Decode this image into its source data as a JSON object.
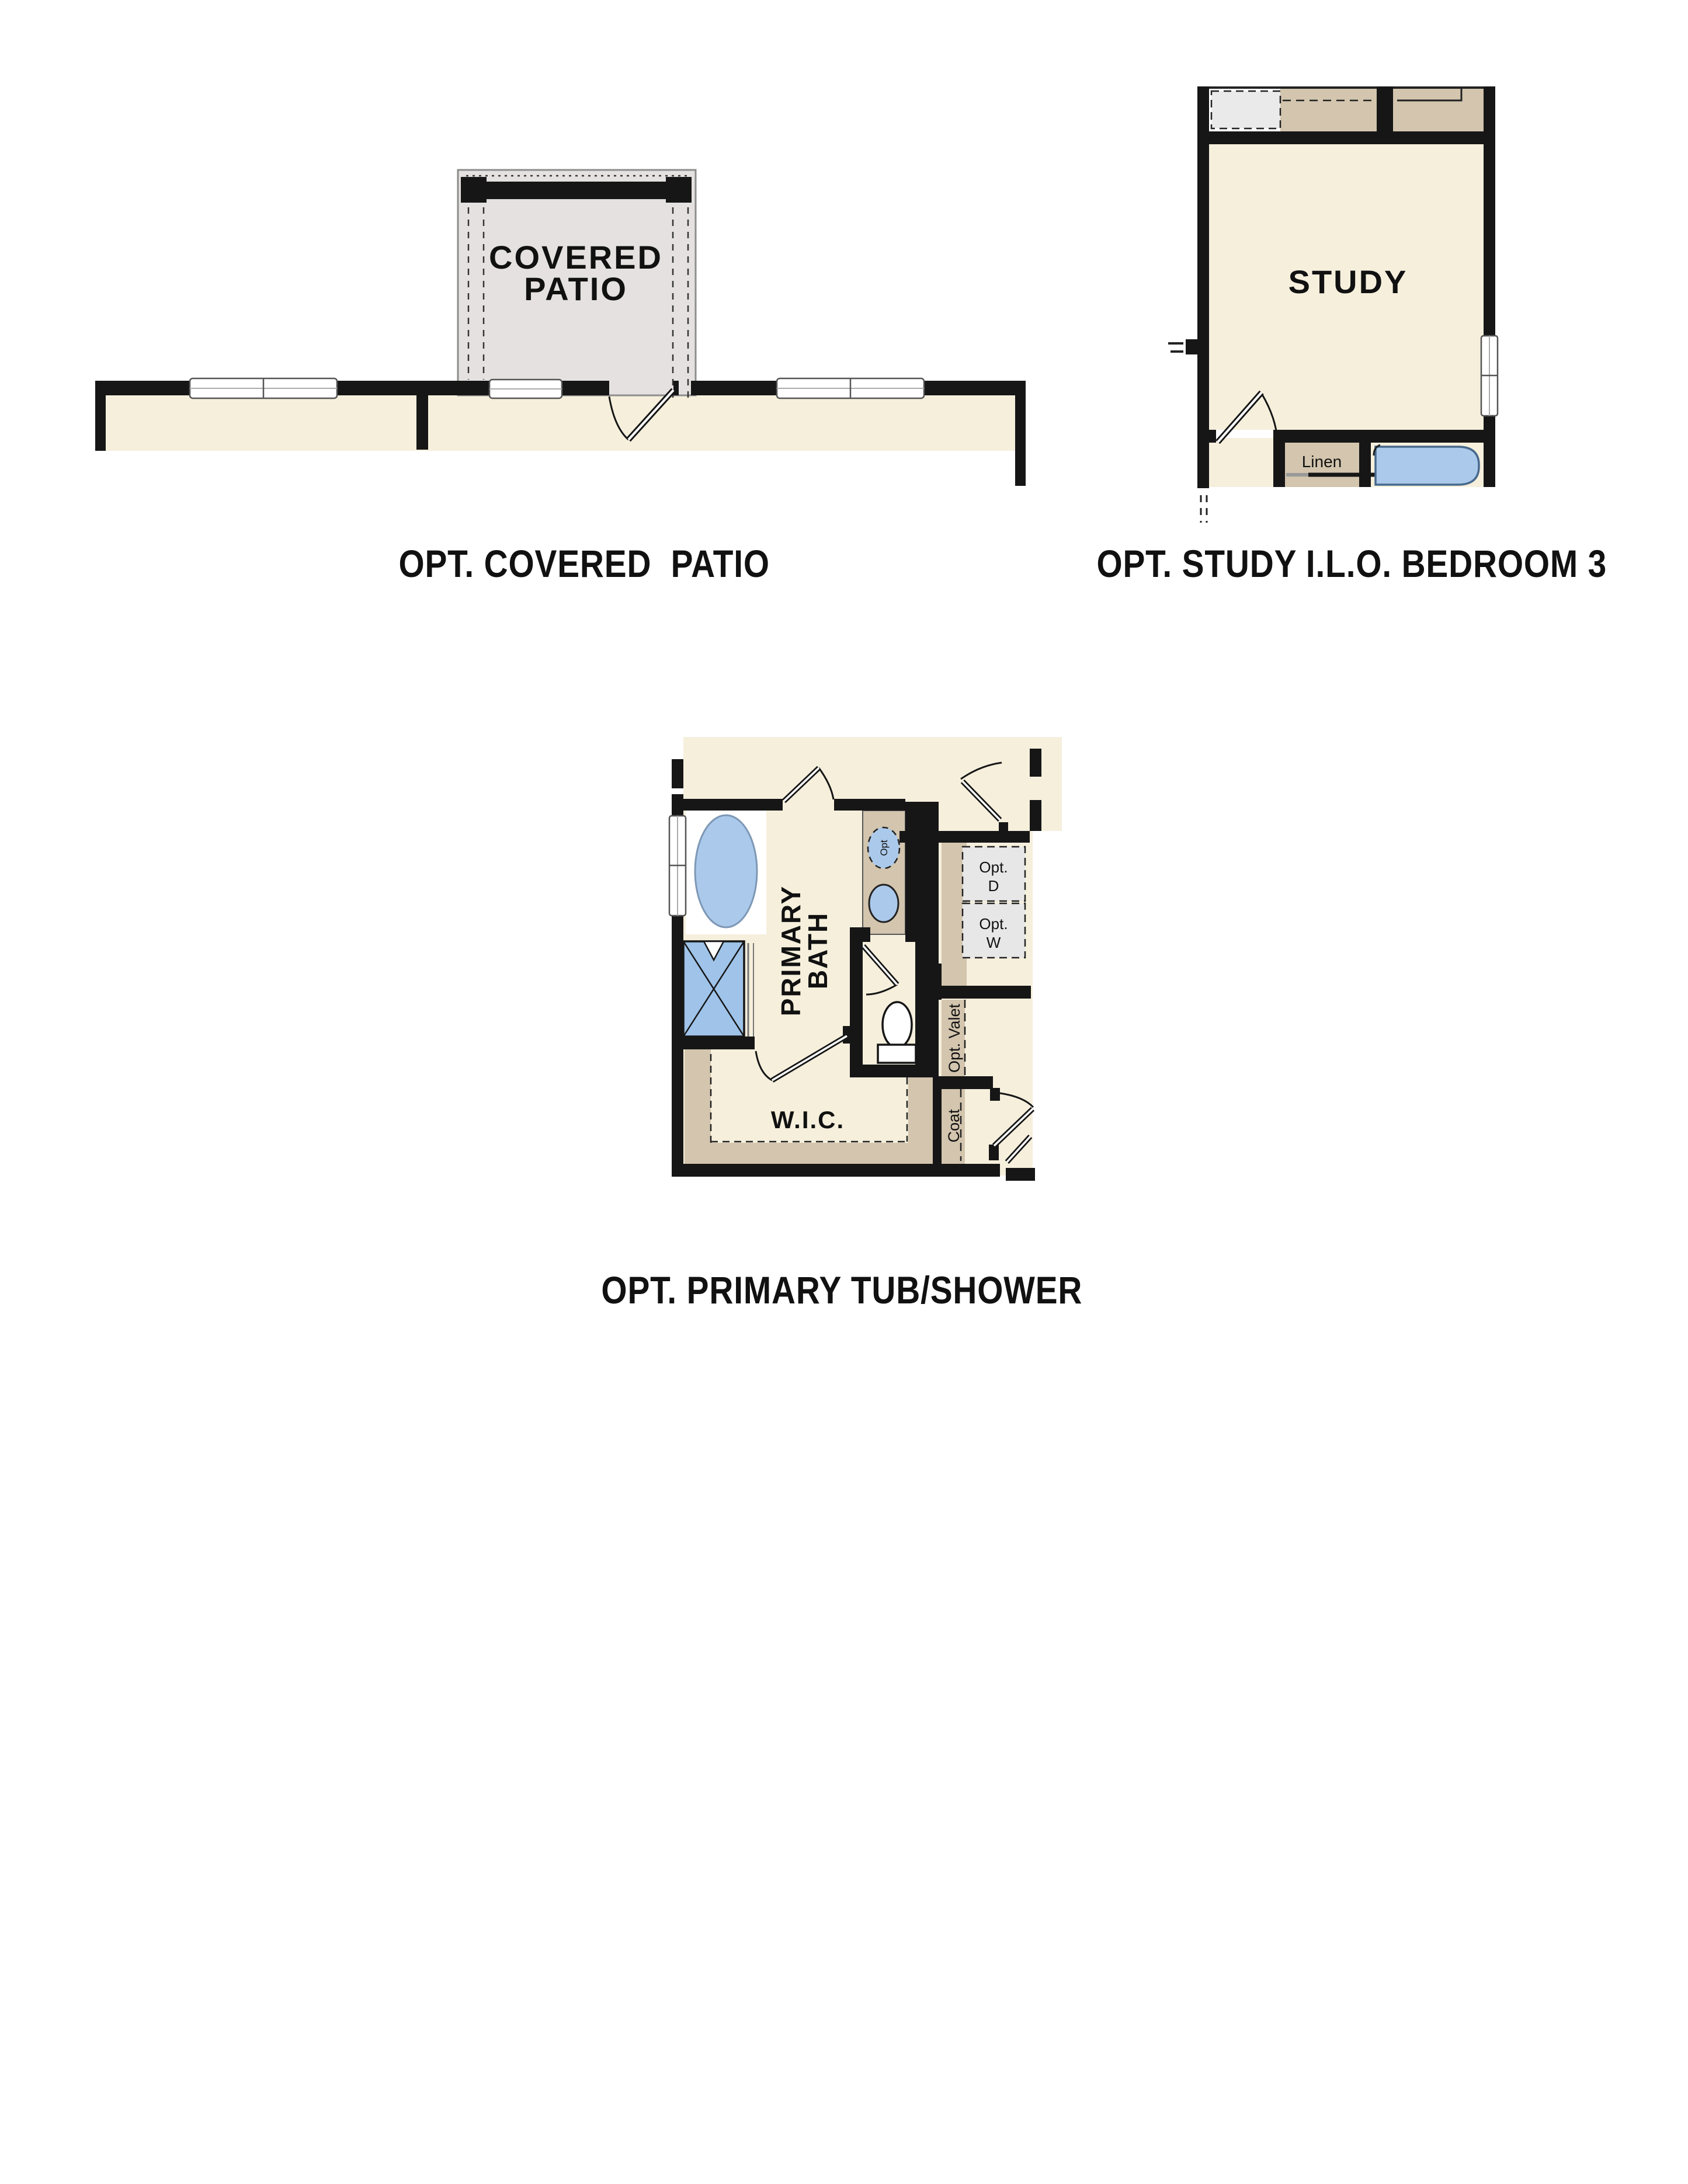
{
  "plans": {
    "covered_patio": {
      "title": "OPT. COVERED  PATIO",
      "room_label": [
        "COVERED",
        "PATIO"
      ]
    },
    "study": {
      "title": "OPT. STUDY I.L.O. BEDROOM 3",
      "room_label": "STUDY",
      "linen_label": "Linen"
    },
    "primary_bath": {
      "title": "OPT. PRIMARY TUB/SHOWER",
      "room_label": [
        "PRIMARY",
        "BATH"
      ],
      "wic_label": "W.I.C.",
      "opt_dryer": [
        "Opt.",
        "D"
      ],
      "opt_washer": [
        "Opt.",
        "W"
      ],
      "valet_label": "Opt. Valet",
      "coat_label": "Coat",
      "sink_opt_label": "Opt"
    }
  },
  "colors": {
    "wall": "#161616",
    "floor": "#f5efdc",
    "patio_slab": "#e4e1e0",
    "casework_tan": "#d3c5ae",
    "fixture_blue": "#abc9ea",
    "shower_blue": "#9fc3e9",
    "opt_box_gray": "#e7e7e7",
    "dashed_box_gray": "#eaeaea"
  }
}
